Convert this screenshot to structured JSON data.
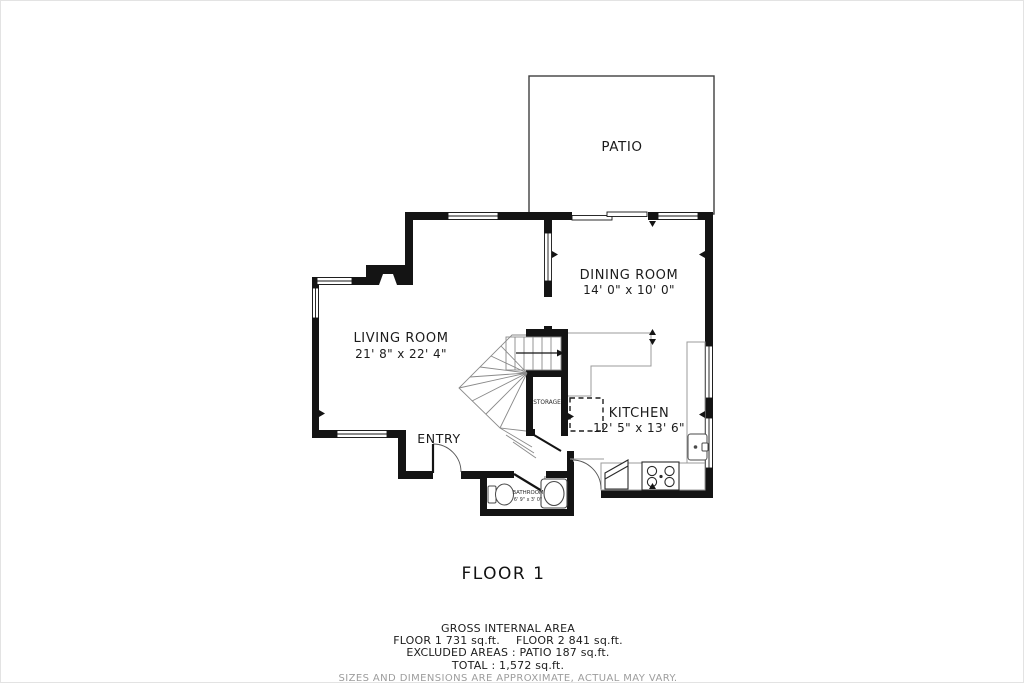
{
  "title": "FLOOR 1",
  "rooms": {
    "patio": {
      "label": "PATIO"
    },
    "dining": {
      "label": "DINING ROOM",
      "dims": "14' 0\" x 10' 0\""
    },
    "living": {
      "label": "LIVING ROOM",
      "dims": "21' 8\" x 22' 4\""
    },
    "kitchen": {
      "label": "KITCHEN",
      "dims": "12' 5\" x 13' 6\""
    },
    "storage": {
      "label": "STORAGE"
    },
    "entry": {
      "label": "ENTRY"
    },
    "bathroom": {
      "label": "BATHROOM",
      "dims": "6' 9\" x 3' 0\""
    }
  },
  "footer": {
    "gross_title": "GROSS INTERNAL AREA",
    "floor1": "FLOOR 1 731 sq.ft.",
    "floor2": "FLOOR 2 841 sq.ft.",
    "excluded": "EXCLUDED AREAS :  PATIO 187 sq.ft.",
    "total": "TOTAL :  1,572 sq.ft.",
    "disclaimer": "SIZES AND DIMENSIONS ARE APPROXIMATE, ACTUAL MAY VARY."
  },
  "colors": {
    "wall": "#141414",
    "thin_line": "#4a4a4a",
    "stair_line": "#8a8a8a",
    "counter_line": "#9b9b9b",
    "disclaimer_text": "#9d9d9d"
  }
}
